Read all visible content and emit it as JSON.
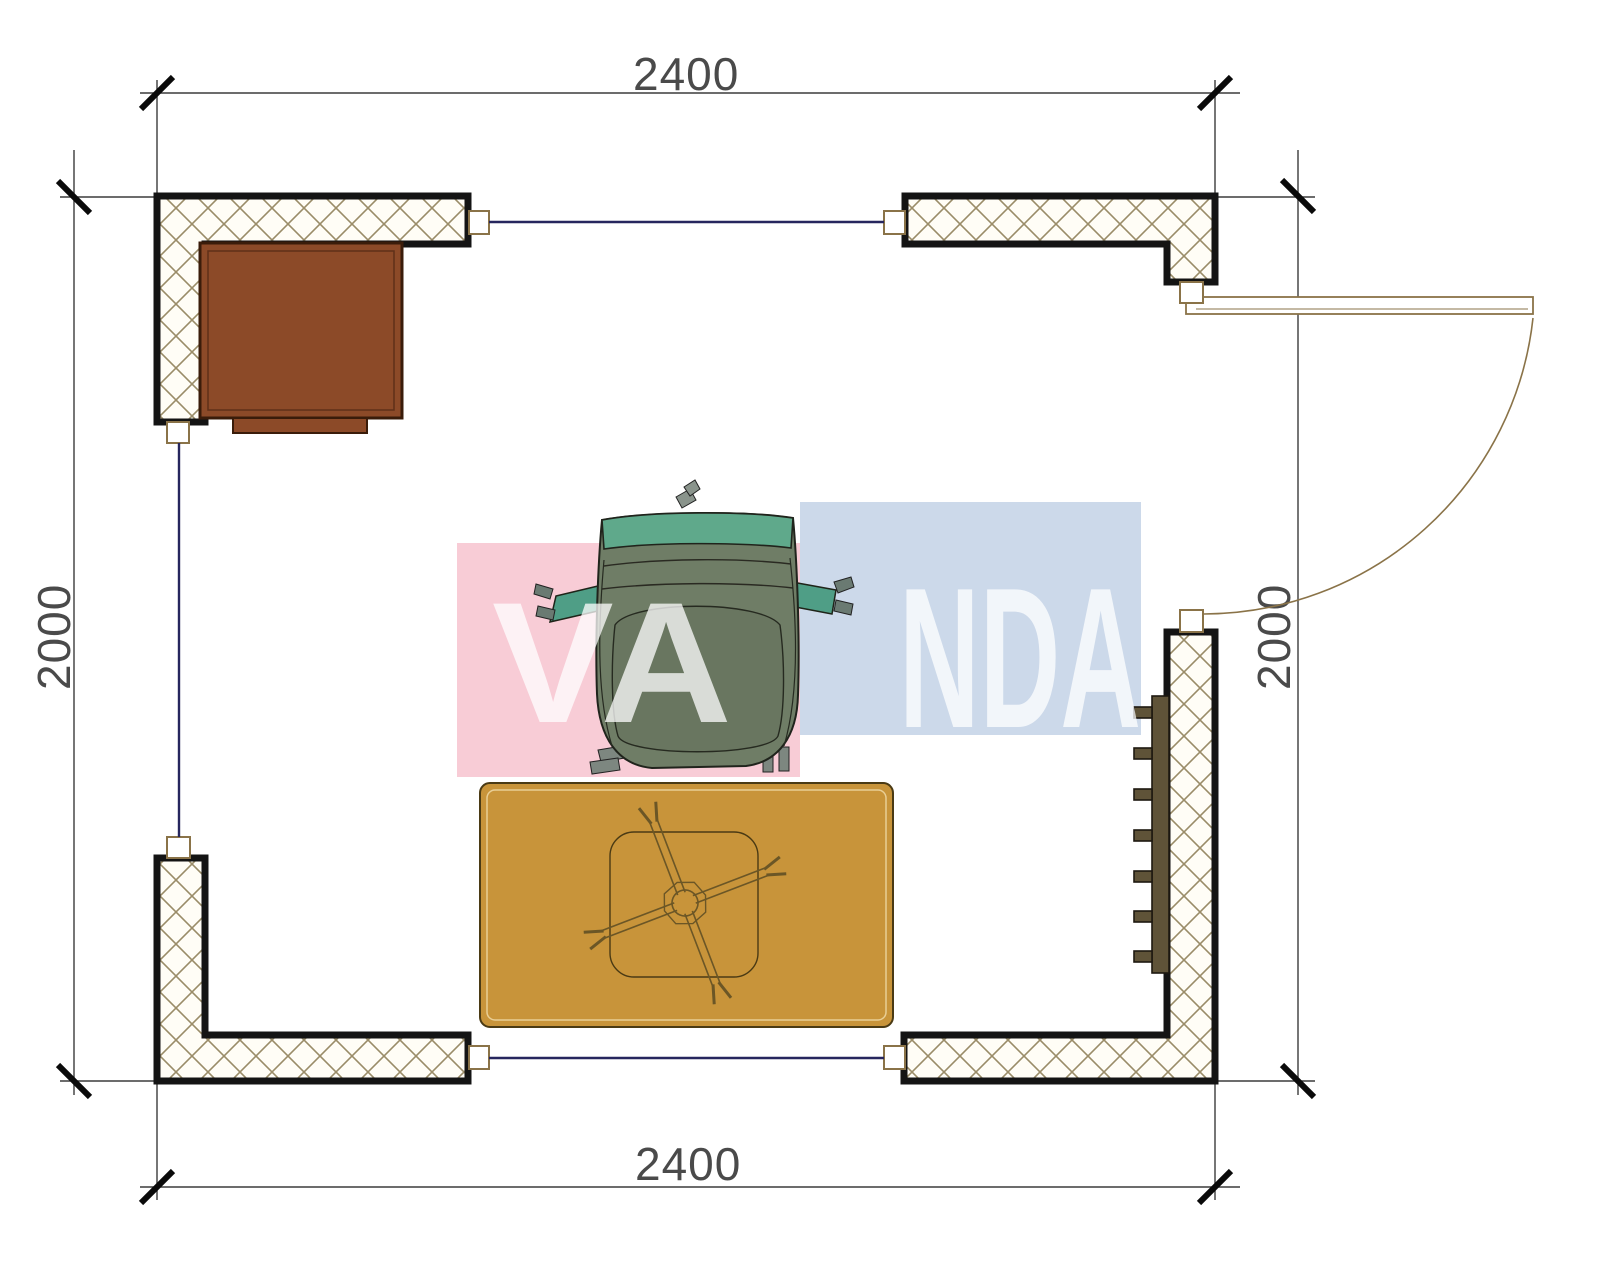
{
  "page": {
    "type": "architectural floor plan drawing",
    "background": "#ffffff"
  },
  "dimensions": {
    "top": "2400",
    "bottom": "2400",
    "left": "2000",
    "right": "2000"
  },
  "watermark": {
    "text": "VANDA",
    "left_part": "VA",
    "right_part": "NDA",
    "pink_block": "#f8ccd6",
    "blue_block": "#ccd9ea",
    "text_color": "rgba(255,255,255,0.75)"
  },
  "plan": {
    "room_width_mm": "2400",
    "room_depth_mm": "2000",
    "walls": [
      "corner wall top-left",
      "corner wall top-right",
      "corner wall bottom-left",
      "corner wall bottom-right"
    ],
    "openings": [
      "window top",
      "window left",
      "window bottom",
      "door right with swing arc"
    ],
    "furniture": [
      "cabinet",
      "armchair",
      "rug",
      "ceiling-fan symbol",
      "radiator"
    ]
  },
  "colors": {
    "wall_outline": "#141414",
    "wall_hatch": "#9a8c68",
    "window_line": "#26265e",
    "dimension_line": "#3c3c3c",
    "door_line": "#8a7348",
    "cabinet_fill": "#8c4a28",
    "rug_fill": "#c8943a",
    "radiator_fill": "#5f5338",
    "chair_body": "#6f7d66",
    "chair_back": "#5fa98b",
    "chair_arm": "#4f9e86"
  }
}
